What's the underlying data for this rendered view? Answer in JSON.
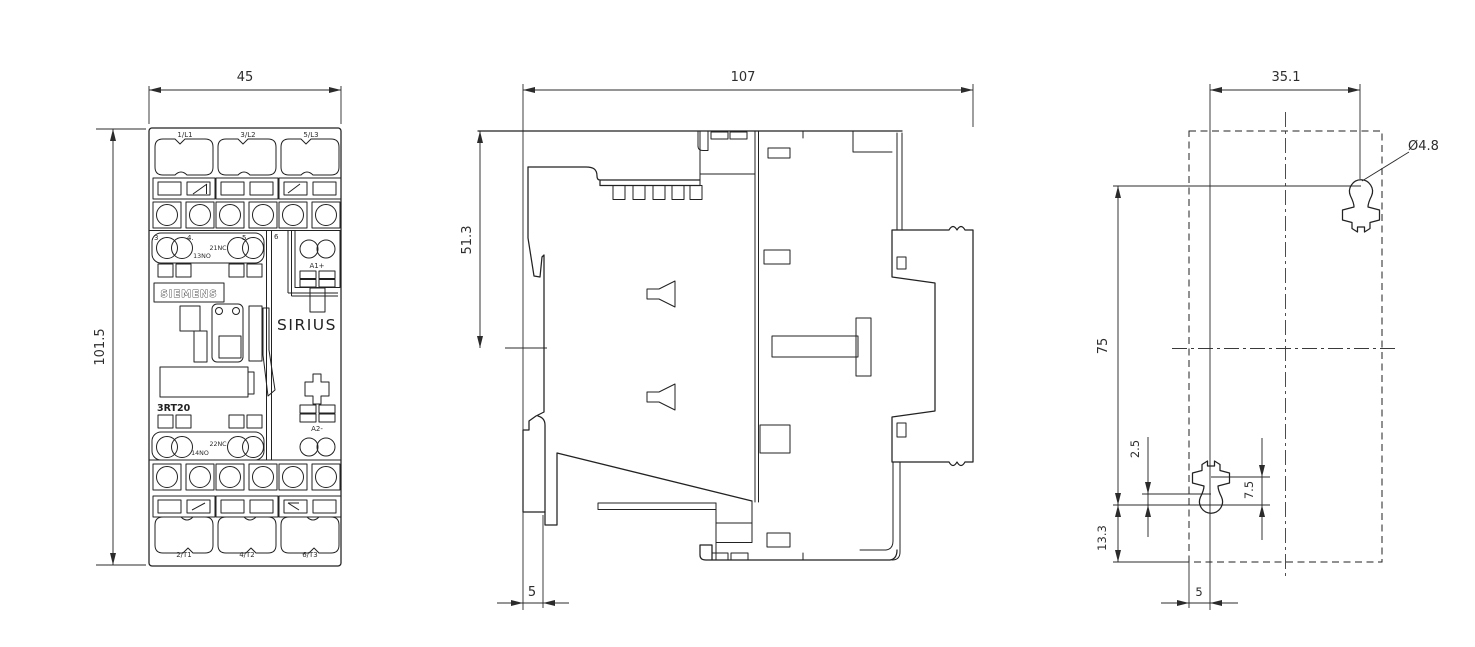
{
  "drawing": {
    "front_view": {
      "dims": {
        "width": "45",
        "height": "101.5"
      },
      "labels": {
        "top_terminals": [
          "1/L1",
          "3/L2",
          "5/L3"
        ],
        "bottom_terminals": [
          "2/T1",
          "4/T2",
          "6/T3"
        ],
        "aux_numbers": [
          "3",
          "4.",
          "5",
          "6"
        ],
        "nc_upper": "21NC",
        "no_upper": "13NO",
        "nc_lower": "22NC",
        "no_lower": "14NO",
        "coil_plus": "A1+",
        "coil_minus": "A2-",
        "brand": "SIEMENS",
        "series": "SIRIUS",
        "model": "3RT20"
      }
    },
    "side_view": {
      "dims": {
        "depth": "107",
        "upper_depth": "51.3",
        "din_offset": "5"
      }
    },
    "drill_plan": {
      "dims": {
        "hole_spacing_horizontal": "35.1",
        "hole_diameter": "Ø4.8",
        "hole_spacing_vertical": "75",
        "keyhole_offset": "2.5",
        "slot_height": "7.5",
        "bottom_edge_offset": "13.3",
        "side_edge_offset": "5"
      }
    },
    "line_color": "#222222",
    "background": "#ffffff"
  }
}
